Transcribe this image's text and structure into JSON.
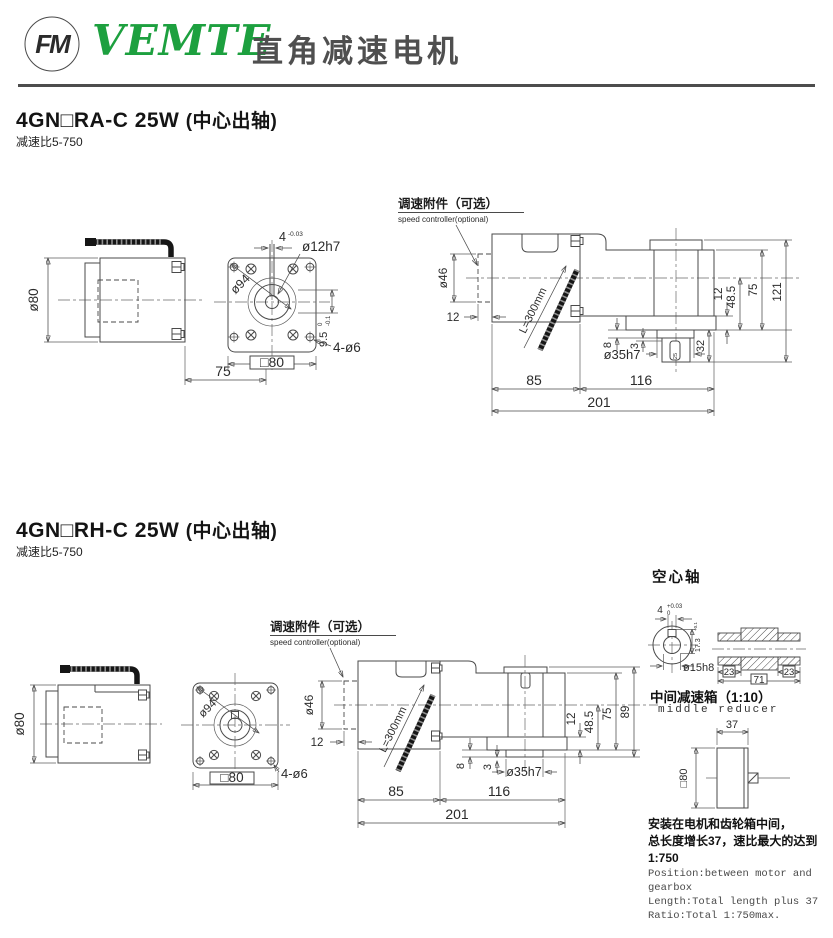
{
  "header": {
    "logo_text": "FM",
    "brand": "VEMTE",
    "product": "直角减速电机"
  },
  "section1": {
    "model": "4GN□RA-C 25W",
    "note": "(中心出轴)",
    "ratio": "减速比5-750",
    "d": {
      "body_dia": "ø80",
      "body_len": "75",
      "key_w": "4",
      "key_tol": "-0.03",
      "shaft_dia": "ø12h7",
      "bolt_circle": "ø94",
      "boss_h": "9.5",
      "boss_tol_hi": "0",
      "boss_tol_lo": "-0.1",
      "holes": "4-ø6",
      "flange_sq": "□80",
      "ctrl_cn": "调速附件（可选）",
      "ctrl_en": "speed controller(optional)",
      "ctrl_dia": "ø46",
      "ctrl_w": "12",
      "cable": "L=300mm",
      "gap8": "8",
      "gap3": "3",
      "out_dia": "ø35h7",
      "shaft_len": "32",
      "key_len": "25",
      "flange_t": "12",
      "axis_h": "48.5",
      "box_h": "75",
      "total_h": "121",
      "motor_l": "85",
      "box_l": "116",
      "total_l": "201"
    }
  },
  "section2": {
    "model": "4GN□RH-C 25W",
    "note": "(中心出轴)",
    "ratio": "减速比5-750",
    "d": {
      "body_dia": "ø80",
      "bolt_circle": "ø94",
      "holes": "4-ø6",
      "flange_sq": "□80",
      "ctrl_cn": "调速附件（可选）",
      "ctrl_en": "speed controller(optional)",
      "ctrl_dia": "ø46",
      "ctrl_w": "12",
      "cable": "L=300mm",
      "gap8": "8",
      "gap3": "3",
      "out_dia": "ø35h7",
      "flange_t": "12",
      "axis_h": "48.5",
      "box_h": "75",
      "total_h": "89",
      "motor_l": "85",
      "box_l": "116",
      "total_l": "201"
    }
  },
  "hollow_shaft": {
    "title": "空心轴",
    "key_w": "4",
    "key_tol_hi": "+0.03",
    "key_tol_lo": "0",
    "key_depth": "17.3",
    "key_depth_tol": "+0.1",
    "bore": "ø15h8",
    "end_a": "23",
    "end_b": "23",
    "length": "71"
  },
  "middle_reducer": {
    "title_cn": "中间减速箱（1:10）",
    "title_en": "middle reducer",
    "width": "37",
    "frame": "□80"
  },
  "notes": {
    "cn1": "安装在电机和齿轮箱中间，",
    "cn2": "总长度增长37，速比最大的达到1:750",
    "en1": "Position:between motor and gearbox",
    "en2": "Length:Total length plus 37",
    "en3": "Ratio:Total 1:750max."
  }
}
